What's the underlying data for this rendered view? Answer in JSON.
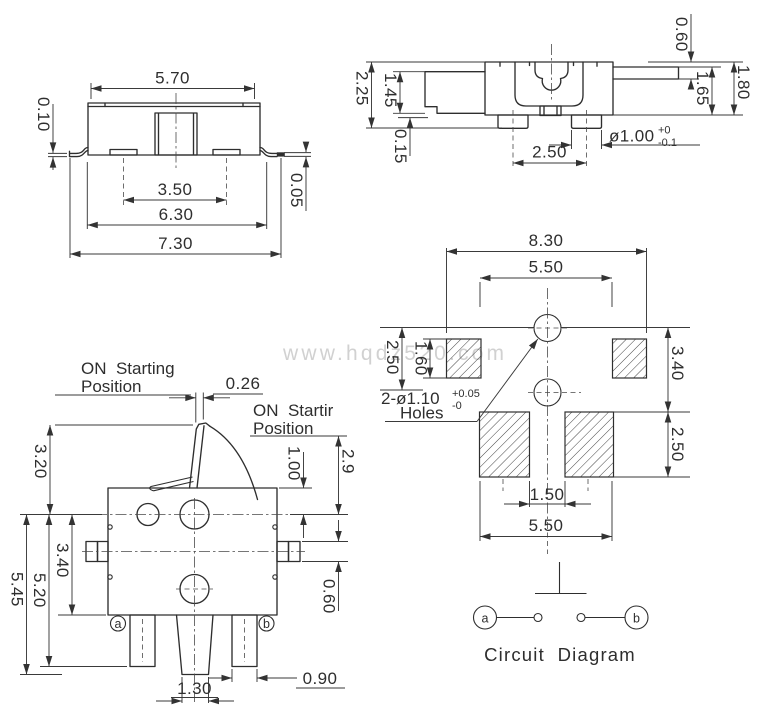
{
  "watermark": "www.hqdz520.com",
  "front_view": {
    "top_width": "5.70",
    "lead_thickness": "0.10",
    "pad_pitch": "3.50",
    "lead_span": "6.30",
    "total_width": "7.30",
    "standoff": "0.05"
  },
  "top_view": {
    "tip_gap": "0.60",
    "total_height": "2.25",
    "arm_height": "1.45",
    "foot_standoff": "0.15",
    "shaft_to_base": "1.65",
    "body_height": "1.80",
    "foot_pitch": "2.50",
    "foot_dia": "ø1.00",
    "foot_dia_tol_plus": "+0",
    "foot_dia_tol_minus": "-0.1"
  },
  "lever_view": {
    "on_left_line1": "ON  Starting",
    "on_left_line2": "Position",
    "on_right_line1": "ON  Startir",
    "on_right_line2": "Position",
    "lever_width": "0.26",
    "lever_height": "3.20",
    "shoulder_height": "1.00",
    "tip_height": "2.9",
    "body_height": "3.40",
    "total_height": "5.45",
    "leg_height": "5.20",
    "bump_height": "0.60",
    "center_leg_width": "1.30",
    "outer_leg_width": "0.90",
    "terminal_a": "a",
    "terminal_b": "b"
  },
  "pcb_view": {
    "outer_width": "8.30",
    "inner_width": "5.50",
    "hole_offset": "2.50",
    "pad_height": "1.60",
    "row_span": "3.40",
    "lower_pad_height": "2.50",
    "pad_gap": "1.50",
    "lower_width": "5.50",
    "holes_note": "2-ø1.10",
    "holes_tol_plus": "+0.05",
    "holes_tol_minus": "-0",
    "holes_label": "Holes"
  },
  "circuit": {
    "terminal_a": "a",
    "terminal_b": "b",
    "caption": "Circuit  Diagram"
  }
}
